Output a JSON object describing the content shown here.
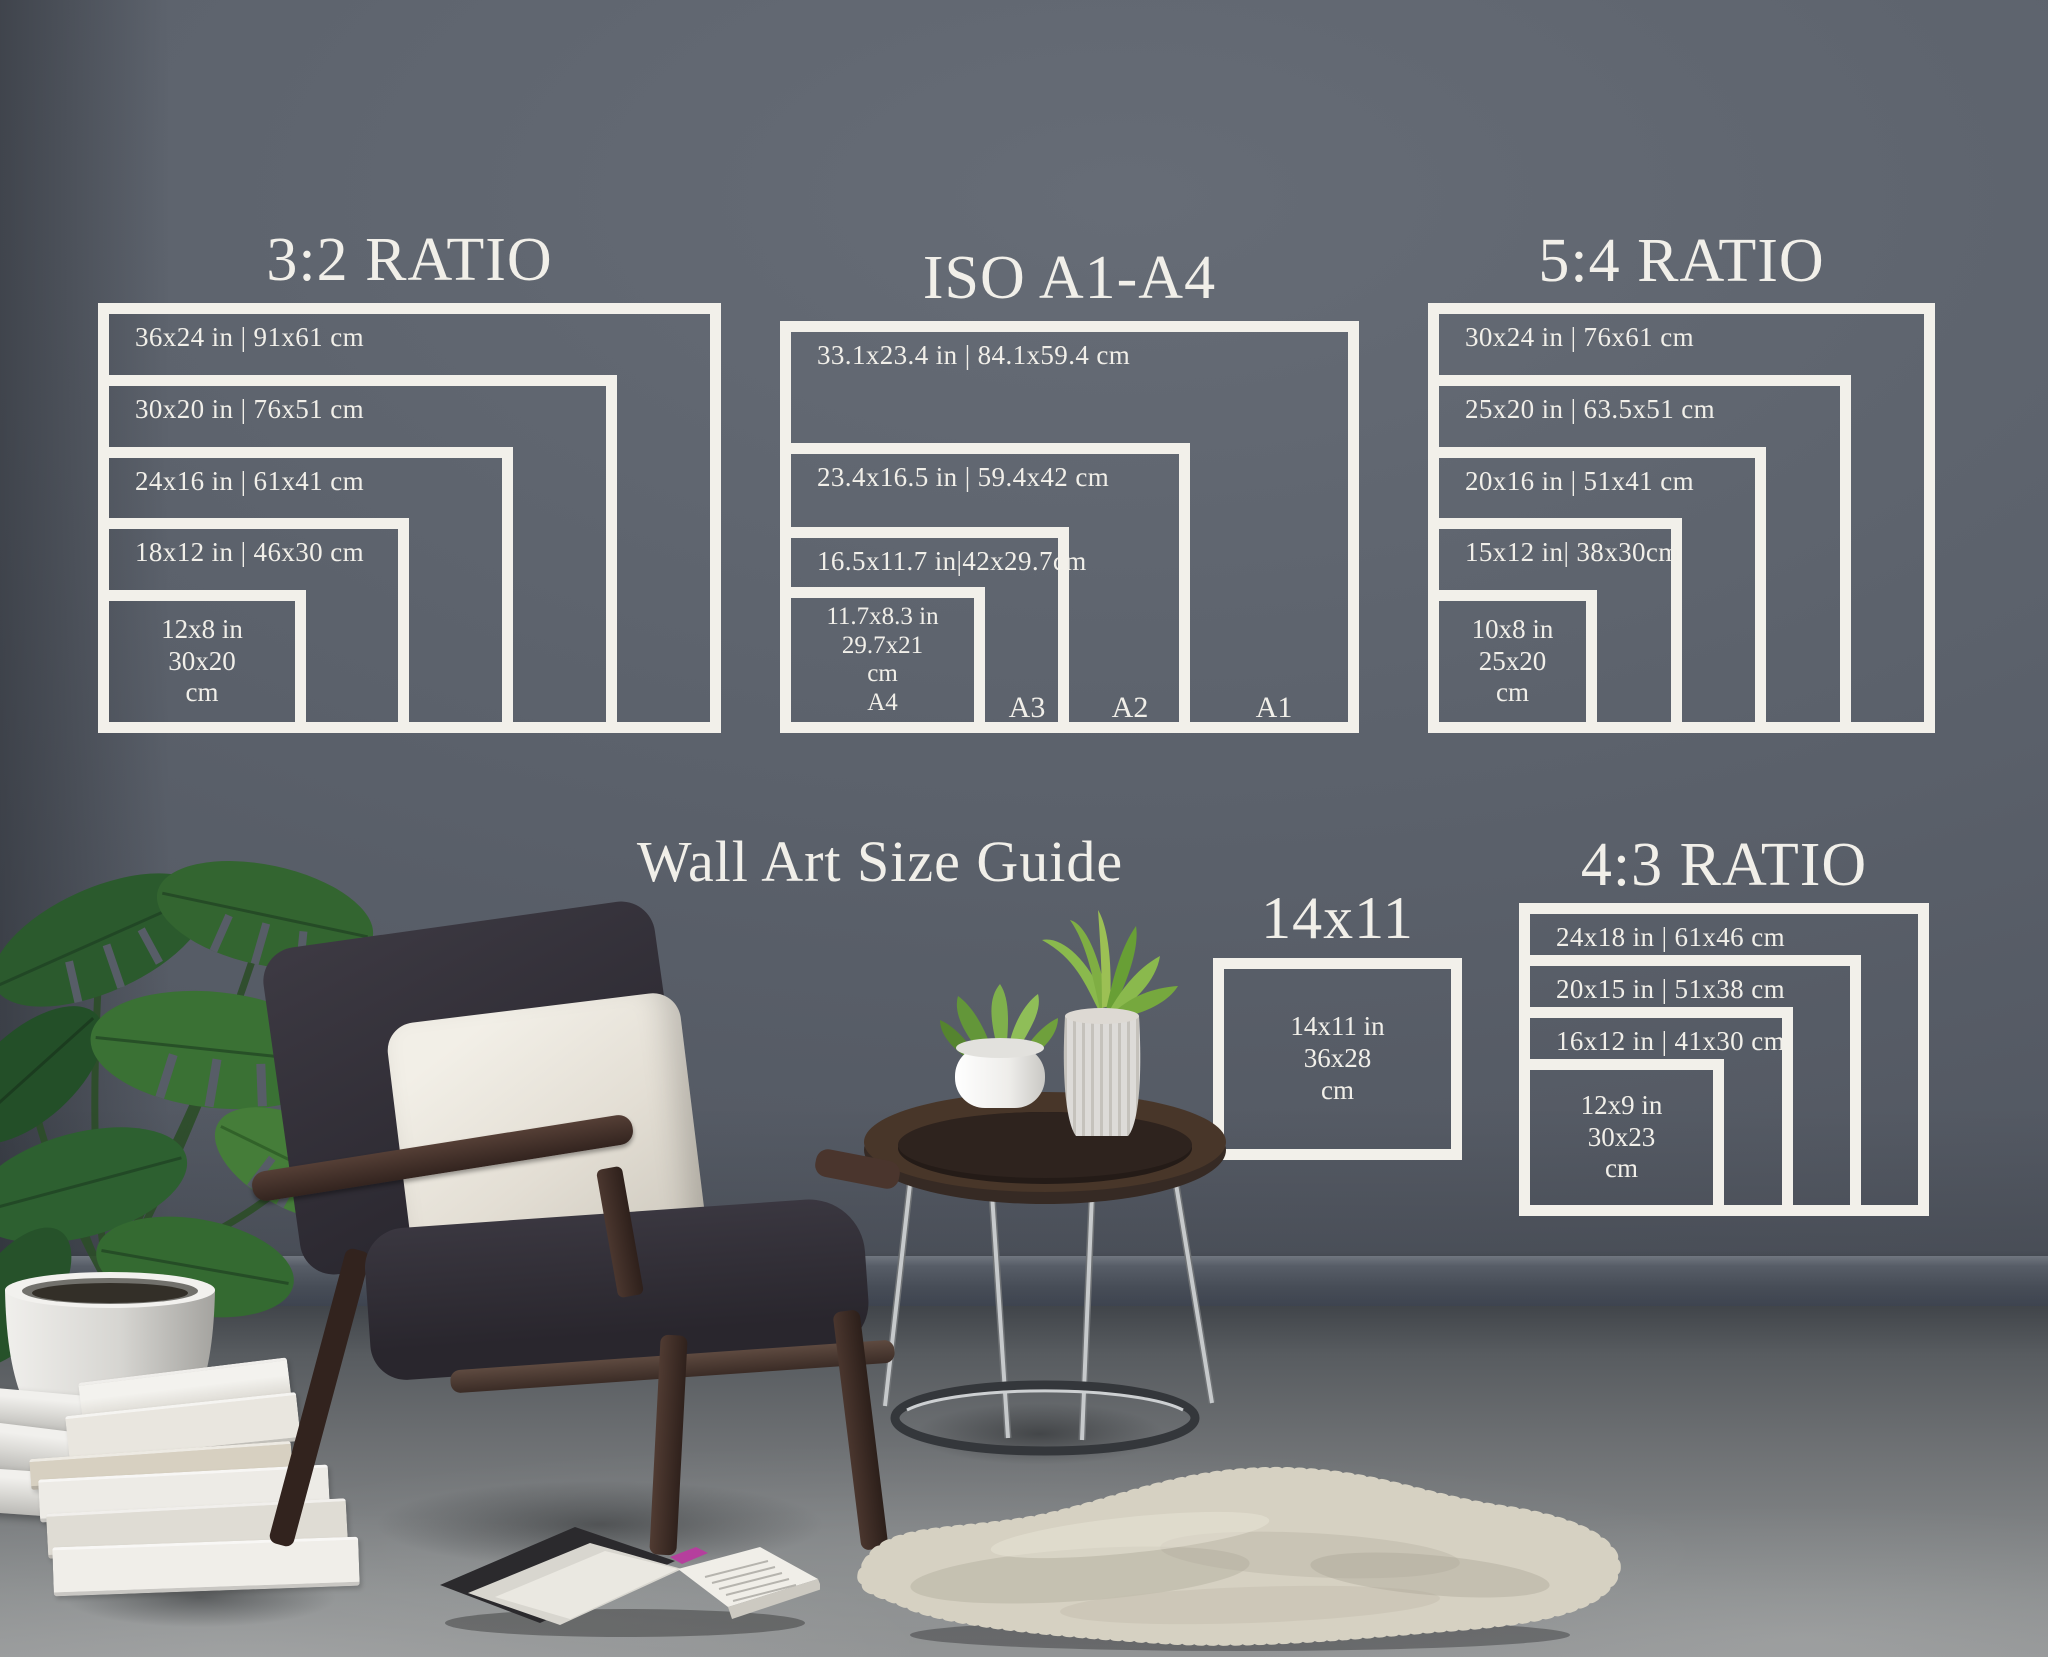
{
  "title": {
    "text": "Wall Art Size Guide"
  },
  "colors": {
    "wall": "#5b616b",
    "guide_line": "#f2f0ea",
    "guide_text": "#f1efe9",
    "baseboard": "#4c525c",
    "floor": "#8b8e8f",
    "rug": "#d6d1c2",
    "plant_green": "#35682f",
    "wood_dark": "#3a2b25",
    "pillow_cream": "#efece4",
    "bookmark_pink": "#b53f9d"
  },
  "sections": {
    "ratio32": {
      "title": "3:2 RATIO",
      "frames": [
        {
          "label": "36x24 in | 91x61 cm"
        },
        {
          "label": "30x20 in | 76x51 cm"
        },
        {
          "label": "24x16 in | 61x41 cm"
        },
        {
          "label": "18x12 in | 46x30 cm"
        },
        {
          "lines": [
            "12x8 in",
            "30x20",
            "cm"
          ]
        }
      ]
    },
    "iso": {
      "title": "ISO A1-A4",
      "frames": [
        {
          "label": "33.1x23.4 in | 84.1x59.4 cm",
          "corner": "A1"
        },
        {
          "label": "23.4x16.5 in | 59.4x42 cm",
          "corner": "A2"
        },
        {
          "label": "16.5x11.7 in|42x29.7cm",
          "corner": "A3"
        },
        {
          "lines": [
            "11.7x8.3 in",
            "29.7x21",
            "cm",
            "A4"
          ]
        }
      ]
    },
    "ratio54": {
      "title": "5:4 RATIO",
      "frames": [
        {
          "label": "30x24 in | 76x61 cm"
        },
        {
          "label": "25x20 in | 63.5x51 cm"
        },
        {
          "label": "20x16 in | 51x41 cm"
        },
        {
          "label": "15x12 in| 38x30cm"
        },
        {
          "lines": [
            "10x8 in",
            "25x20",
            "cm"
          ]
        }
      ]
    },
    "single1411": {
      "title": "14x11",
      "frame": {
        "lines": [
          "14x11 in",
          "36x28",
          "cm"
        ]
      }
    },
    "ratio43": {
      "title": "4:3 RATIO",
      "frames": [
        {
          "label": "24x18 in | 61x46 cm"
        },
        {
          "label": "20x15 in | 51x38 cm"
        },
        {
          "label": "16x12 in | 41x30 cm"
        },
        {
          "lines": [
            "12x9 in",
            "30x23",
            "cm"
          ]
        }
      ]
    }
  },
  "scene": {
    "objects": [
      "monstera-plant",
      "white-planter-pot",
      "rolled-papers",
      "stacked-books",
      "armchair",
      "throw-pillow",
      "side-table",
      "succulent-pot",
      "ribbed-vase",
      "aloe-plant",
      "sheepskin-rug",
      "open-book",
      "baseboard",
      "concrete-floor"
    ]
  }
}
